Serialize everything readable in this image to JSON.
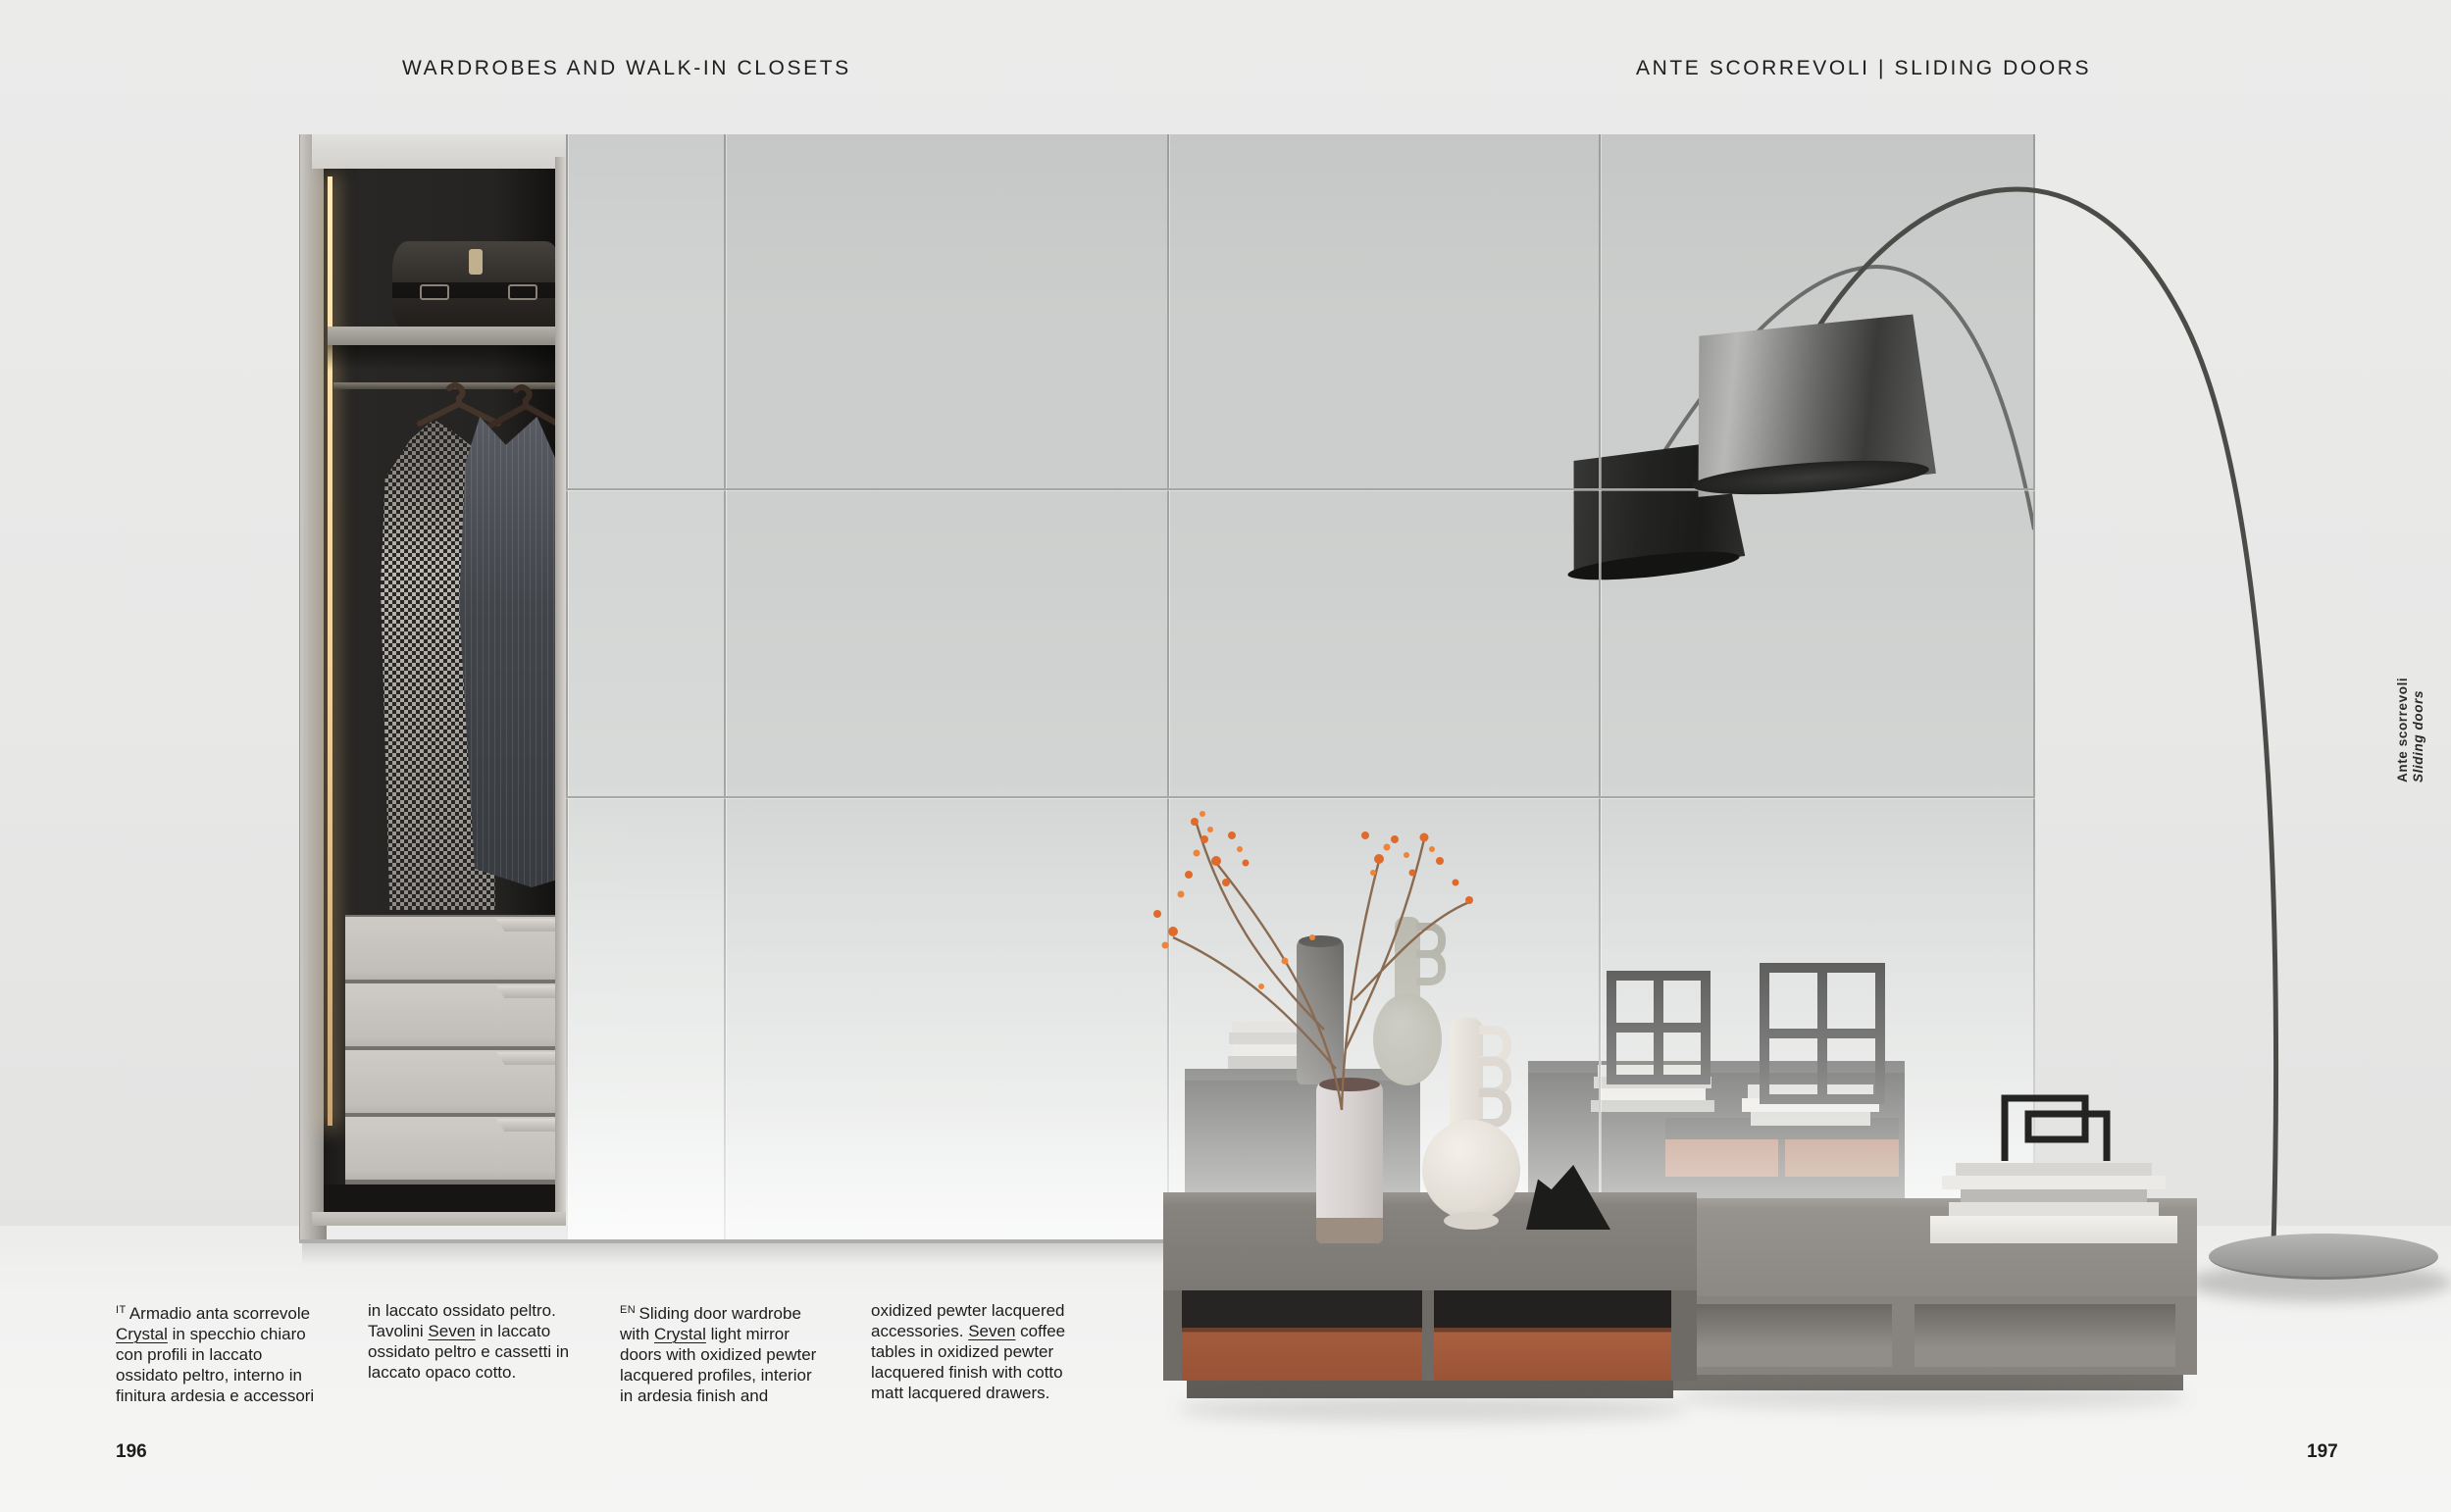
{
  "header": {
    "left": "WARDROBES AND WALK-IN CLOSETS",
    "right": "ANTE SCORREVOLI | SLIDING DOORS"
  },
  "side_label": {
    "line1": "Ante scorrevoli",
    "line2": "Sliding doors"
  },
  "page_numbers": {
    "left": "196",
    "right": "197"
  },
  "captions": {
    "columns": [
      {
        "lines": [
          [
            {
              "t": "IT ",
              "sup": true
            },
            {
              "t": "Armadio anta scorrevole"
            }
          ],
          [
            {
              "t": "Crystal",
              "u": true
            },
            {
              "t": " in specchio chiaro"
            }
          ],
          [
            {
              "t": "con profili in laccato"
            }
          ],
          [
            {
              "t": "ossidato peltro, interno in"
            }
          ],
          [
            {
              "t": "finitura ardesia e accessori"
            }
          ]
        ]
      },
      {
        "lines": [
          [
            {
              "t": "in laccato ossidato peltro."
            }
          ],
          [
            {
              "t": "Tavolini "
            },
            {
              "t": "Seven",
              "u": true
            },
            {
              "t": " in laccato"
            }
          ],
          [
            {
              "t": "ossidato peltro e cassetti in"
            }
          ],
          [
            {
              "t": "laccato opaco cotto."
            }
          ]
        ]
      },
      {
        "lines": [
          [
            {
              "t": "EN ",
              "sup": true
            },
            {
              "t": "Sliding door wardrobe"
            }
          ],
          [
            {
              "t": "with "
            },
            {
              "t": "Crystal",
              "u": true
            },
            {
              "t": " light mirror"
            }
          ],
          [
            {
              "t": "doors with oxidized pewter"
            }
          ],
          [
            {
              "t": "lacquered profiles, interior"
            }
          ],
          [
            {
              "t": "in ardesia finish and"
            }
          ]
        ]
      },
      {
        "lines": [
          [
            {
              "t": "oxidized pewter lacquered"
            }
          ],
          [
            {
              "t": "accessories. "
            },
            {
              "t": "Seven",
              "u": true
            },
            {
              "t": " coffee"
            }
          ],
          [
            {
              "t": "tables in oxidized pewter"
            }
          ],
          [
            {
              "t": "lacquered finish with cotto"
            }
          ],
          [
            {
              "t": "matt lacquered drawers."
            }
          ]
        ]
      }
    ]
  },
  "colors": {
    "page_background": "#ededec",
    "mirror_gray": "#d2d4d3",
    "accent_terracotta": "#a35b3d",
    "lamp_dark": "#3c3c3a",
    "interior_dark": "#232220",
    "led_warm": "#f2d49c",
    "text": "#1d1d1d"
  }
}
